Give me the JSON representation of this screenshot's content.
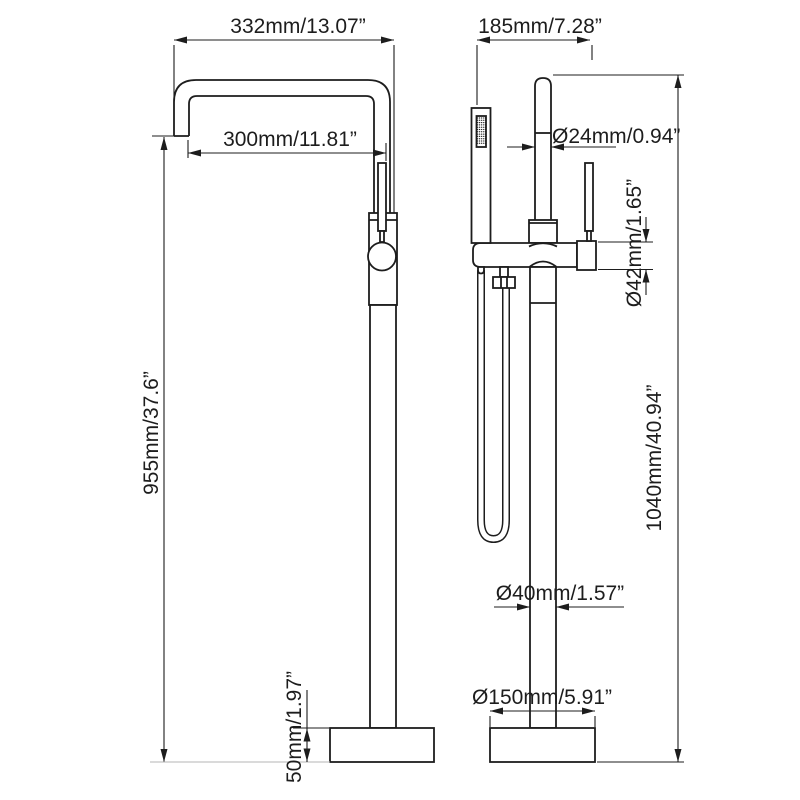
{
  "title": "Freestanding bathtub faucet dimension drawing",
  "colors": {
    "background": "#ffffff",
    "line": "#1d1d1d",
    "floor_line": "#b4b4b4"
  },
  "views": {
    "side": {
      "dimensions": {
        "spout_width": "332mm/13.07”",
        "spout_reach": "300mm/11.81”",
        "overall_height": "955mm/37.6”",
        "base_height": "50mm/1.97”"
      }
    },
    "front": {
      "dimensions": {
        "top_width": "185mm/7.28”",
        "pipe_diameter": "Ø24mm/0.94”",
        "body_diameter": "Ø42mm/1.65”",
        "column_diameter": "Ø40mm/1.57”",
        "base_diameter": "Ø150mm/5.91”",
        "overall_height": "1040mm/40.94”"
      }
    }
  }
}
